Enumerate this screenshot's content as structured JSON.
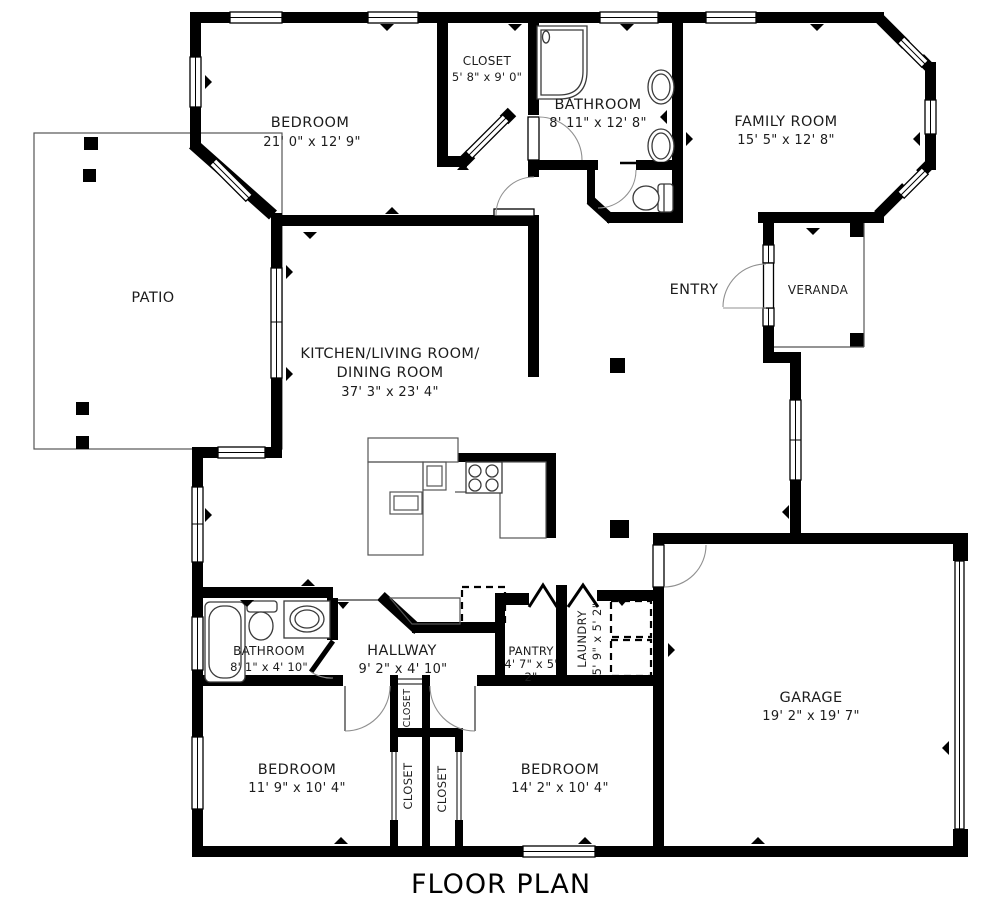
{
  "title": "FLOOR PLAN",
  "colors": {
    "wall": "#000000",
    "background": "#ffffff"
  },
  "rooms": {
    "bedroom1": {
      "name": "BEDROOM",
      "dims": "21' 0\" x 12' 9\""
    },
    "closet1": {
      "name": "CLOSET",
      "dims": "5' 8\" x 9' 0\""
    },
    "bathroom1": {
      "name": "BATHROOM",
      "dims": "8' 11\" x 12' 8\""
    },
    "family": {
      "name": "FAMILY ROOM",
      "dims": "15' 5\" x 12' 8\""
    },
    "patio": {
      "name": "PATIO"
    },
    "kitchen": {
      "name_line1": "KITCHEN/LIVING ROOM/",
      "name_line2": "DINING ROOM",
      "dims": "37' 3\" x 23' 4\""
    },
    "entry": {
      "name": "ENTRY"
    },
    "veranda": {
      "name": "VERANDA"
    },
    "bathroom2": {
      "name": "BATHROOM",
      "dims": "8' 1\" x 4' 10\""
    },
    "hallway": {
      "name": "HALLWAY",
      "dims": "9' 2\" x 4' 10\""
    },
    "pantry": {
      "name": "PANTRY",
      "dims_line1": "4' 7\" x 5'",
      "dims_line2": "2\""
    },
    "laundry": {
      "name": "LAUNDRY",
      "dims": "5' 9\" x 5' 2\""
    },
    "garage": {
      "name": "GARAGE",
      "dims": "19' 2\" x 19' 7\""
    },
    "bedroom2": {
      "name": "BEDROOM",
      "dims": "11' 9\" x 10' 4\""
    },
    "bedroom3": {
      "name": "BEDROOM",
      "dims": "14' 2\" x 10' 4\""
    },
    "closet_hall": {
      "name": "CLOSET"
    },
    "closet_left": {
      "name": "CLOSET"
    },
    "closet_right": {
      "name": "CLOSET"
    }
  }
}
